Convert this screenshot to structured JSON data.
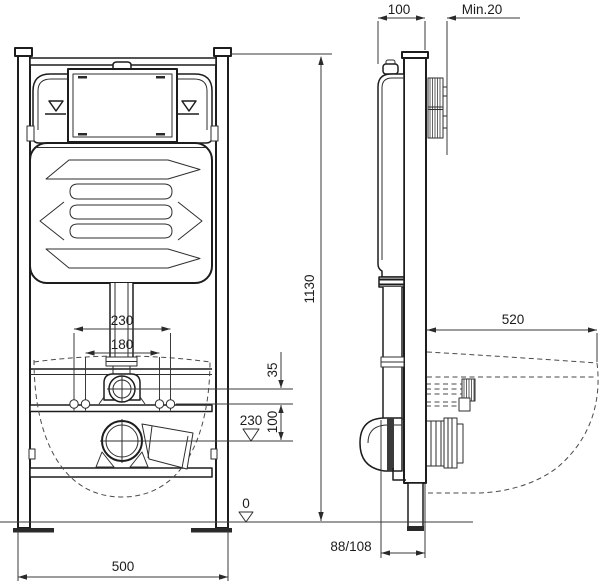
{
  "drawing": {
    "title": "Concealed WC installation frame - dimensional drawing",
    "colors": {
      "line": "#1d1d1d",
      "dimension": "#3a3a3a",
      "dashed": "#4a4a4a",
      "background": "#ffffff"
    },
    "front_view": {
      "frame_height_mm": "1130",
      "frame_width_mm": "500",
      "fixing_spacing_outer_mm": "230",
      "fixing_spacing_inner_mm": "180",
      "supply_offset_mm": "35",
      "outlet_offset_mm": "100",
      "outlet_level_mm": "230",
      "floor_level_mm": "0"
    },
    "side_view": {
      "frame_depth_mm": "100",
      "min_wall_cover": "Min.20",
      "bowl_projection_mm": "520",
      "outlet_distance_mm": "88/108"
    }
  }
}
